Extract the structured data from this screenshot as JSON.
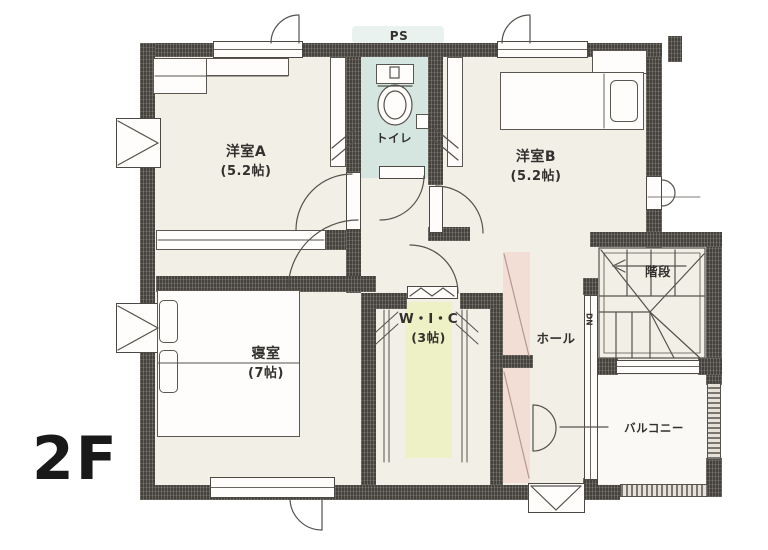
{
  "plan_title": "2F floor plan",
  "annotations": {
    "floor": "2F",
    "ps": "PS",
    "down": "DN"
  },
  "rooms": [
    {
      "id": "room-a",
      "name": "洋室A",
      "size": "(5.2帖)"
    },
    {
      "id": "room-b",
      "name": "洋室B",
      "size": "(5.2帖)"
    },
    {
      "id": "bedroom",
      "name": "寝室",
      "size": "(7帖)"
    },
    {
      "id": "wic",
      "name": "W・I・C",
      "size": "(3帖)"
    },
    {
      "id": "toilet",
      "name": "トイレ",
      "size": ""
    },
    {
      "id": "hall",
      "name": "ホール",
      "size": ""
    },
    {
      "id": "stairs",
      "name": "階段",
      "size": ""
    },
    {
      "id": "balcony",
      "name": "バルコニー",
      "size": ""
    }
  ],
  "colors": {
    "wall": "#45413c",
    "floor": "#f2efe7",
    "toilet_floor": "#d5e5e0",
    "wic_accent": "#eef0c6",
    "hall_accent": "#f3ded6",
    "line": "#55524c",
    "text": "#33312e"
  }
}
